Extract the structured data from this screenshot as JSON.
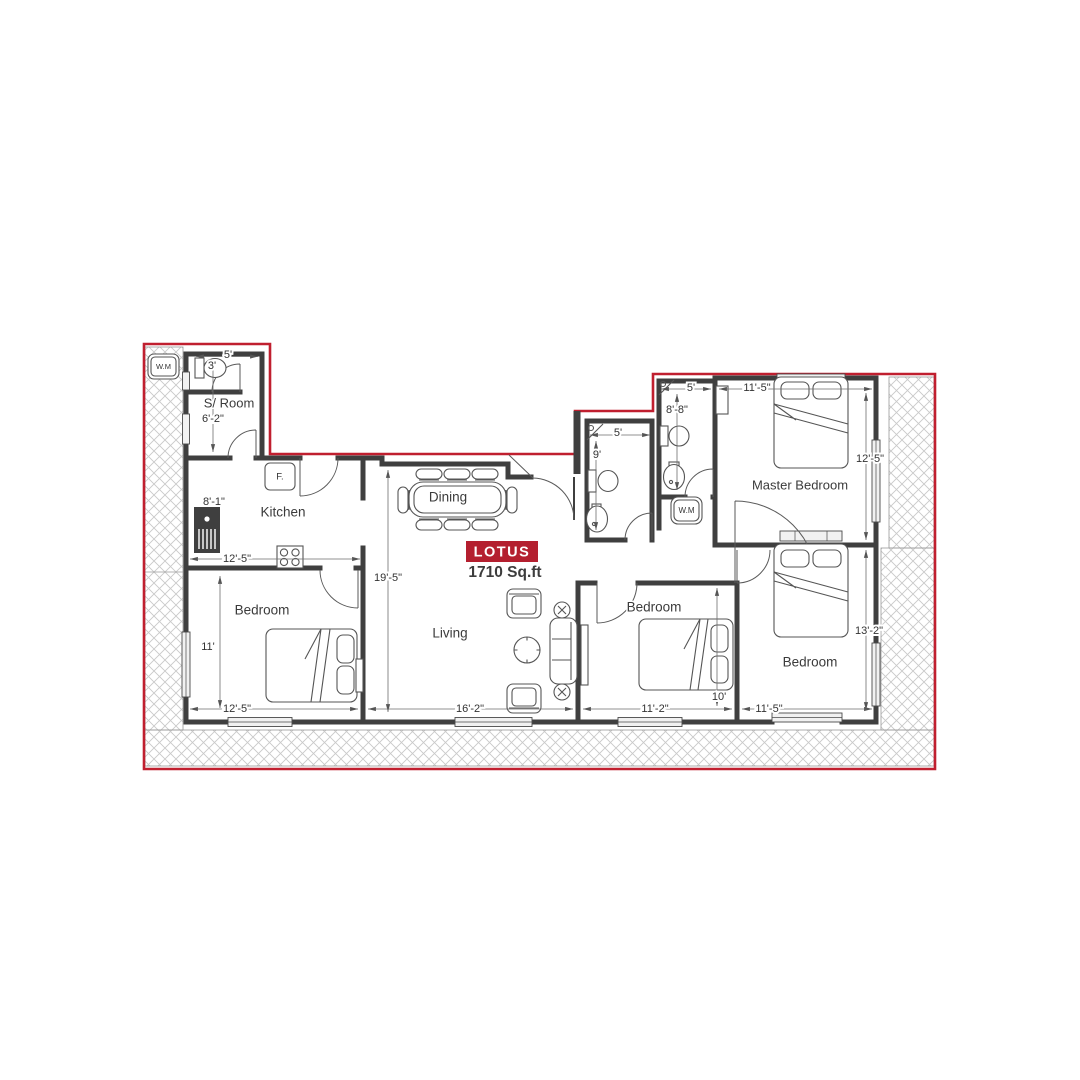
{
  "plan": {
    "name": "LOTUS",
    "area": "1710 Sq.ft"
  },
  "colors": {
    "boundary": "#c01f2f",
    "label_bg": "#b41f2f",
    "wall": "#3f3f3f",
    "line": "#555555",
    "dim": "#333333",
    "roomtext": "#3b3b3b",
    "hatch": "#c9c9c9"
  },
  "rooms": {
    "s_room": {
      "label": "S/ Room",
      "width": "6'-2\""
    },
    "toilet_top": {
      "width": "5'",
      "pan": "3'"
    },
    "kitchen": {
      "label": "Kitchen",
      "width": "12'-5\"",
      "counter": "8'-1\""
    },
    "dining": {
      "label": "Dining"
    },
    "living": {
      "label": "Living",
      "length": "19'-5\"",
      "width": "16'-2\""
    },
    "bedroom_left": {
      "label": "Bedroom",
      "height": "11'",
      "width": "12'-5\""
    },
    "bedroom_middle": {
      "label": "Bedroom",
      "height": "10'",
      "width": "11'-2\""
    },
    "bedroom_right": {
      "label": "Bedroom",
      "height": "13'-2\"",
      "width": "11'-5\""
    },
    "master_bedroom": {
      "label": "Master Bedroom",
      "width": "11'-5\"",
      "height": "12'-5\""
    },
    "bath_top": {
      "width": "5'",
      "height": "8'-8\""
    },
    "bath_mid": {
      "width": "5'",
      "height": "9'"
    }
  },
  "fixtures": {
    "washing_machine_top": "W.M",
    "washing_machine_mid": "W.M",
    "fridge": "F."
  }
}
